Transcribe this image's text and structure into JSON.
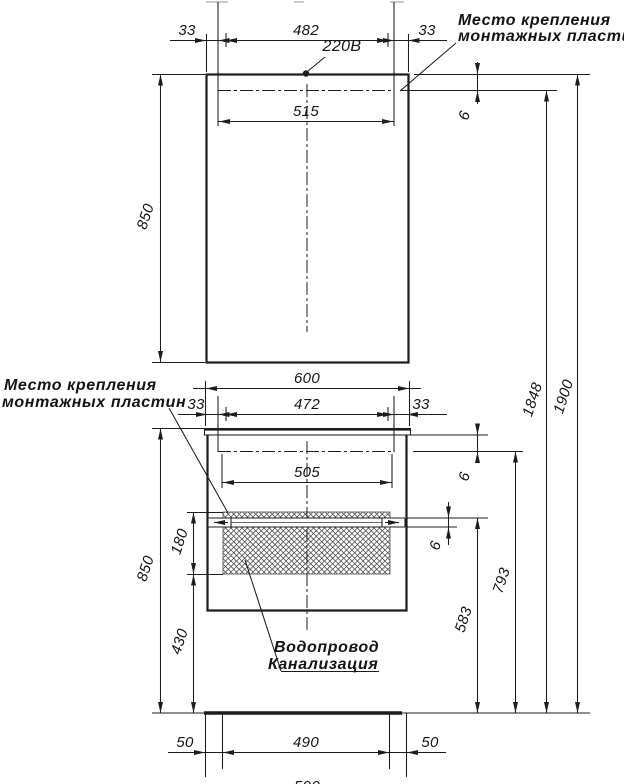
{
  "annotations": {
    "mount_plate_top": {
      "line1": "Место крепления",
      "line2": "монтажных пластин"
    },
    "mount_plate_left": {
      "line1": "Место крепления",
      "line2": "монтажных пластин"
    },
    "power_outlet": "220В",
    "plumbing": {
      "line1": "Водопровод",
      "line2": "Канализация"
    }
  },
  "dimensions": {
    "mirror": {
      "offset_left": "33",
      "mount_span": "482",
      "offset_right": "33",
      "plate_width": "515",
      "height": "850",
      "top_gap": "6"
    },
    "vanity": {
      "width": "600",
      "offset_left": "33",
      "mount_span": "472",
      "offset_right": "33",
      "plate_width": "505",
      "height": "850",
      "hatch_height": "180",
      "below_hatch": "430",
      "counter_gap": "6",
      "plate_gap": "6",
      "plate_floor_height": "583",
      "rail_floor_height": "793"
    },
    "overall": {
      "mount_height": "1848",
      "total_height": "1900"
    },
    "floor": {
      "offset_left": "50",
      "stud_span": "490",
      "offset_right": "50",
      "bottom_width": "590"
    }
  }
}
